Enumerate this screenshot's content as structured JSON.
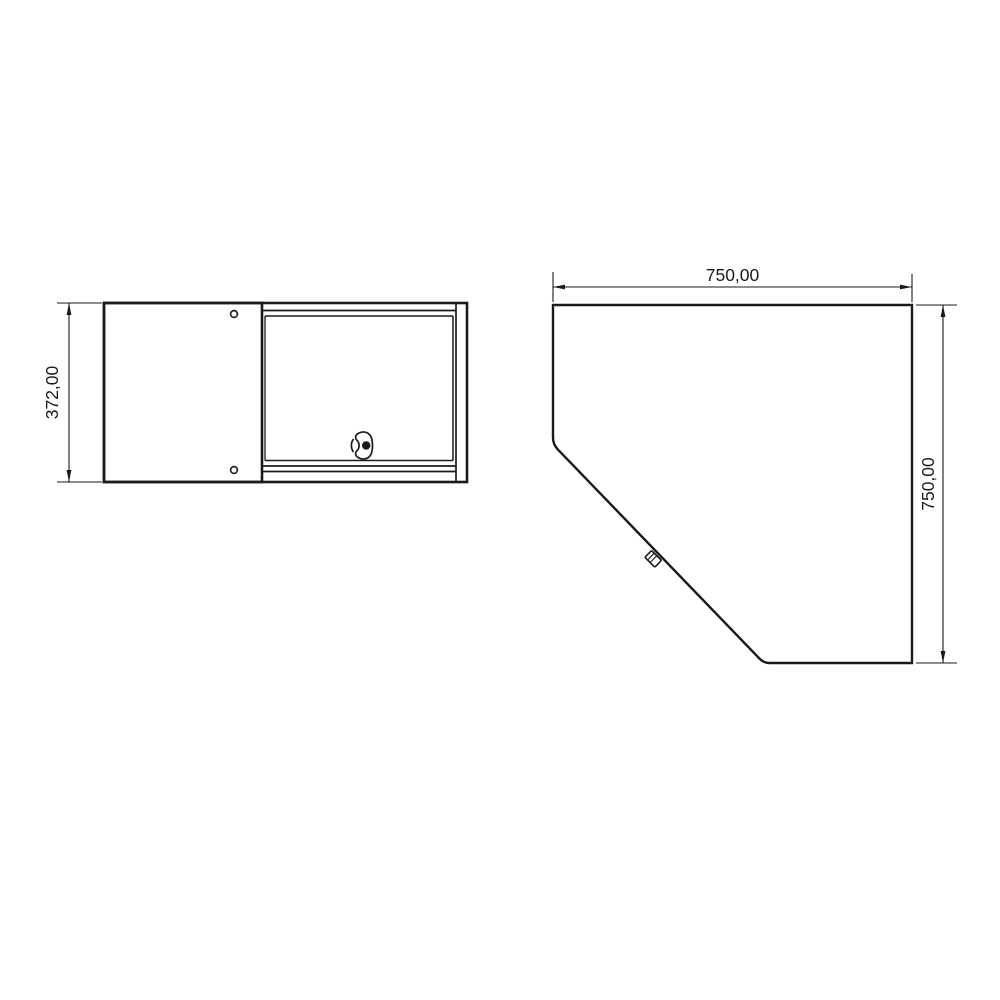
{
  "canvas": {
    "background": "#ffffff",
    "line_color": "#1a1a1a"
  },
  "front_view": {
    "height_dimension_label": "372,00",
    "icons": {
      "handle": "door-handle-icon",
      "screw_top": "screw-hole-icon",
      "screw_bottom": "screw-hole-icon"
    }
  },
  "top_view": {
    "width_dimension_label": "750,00",
    "depth_dimension_label": "750,00",
    "icons": {
      "latch": "latch-icon"
    }
  }
}
